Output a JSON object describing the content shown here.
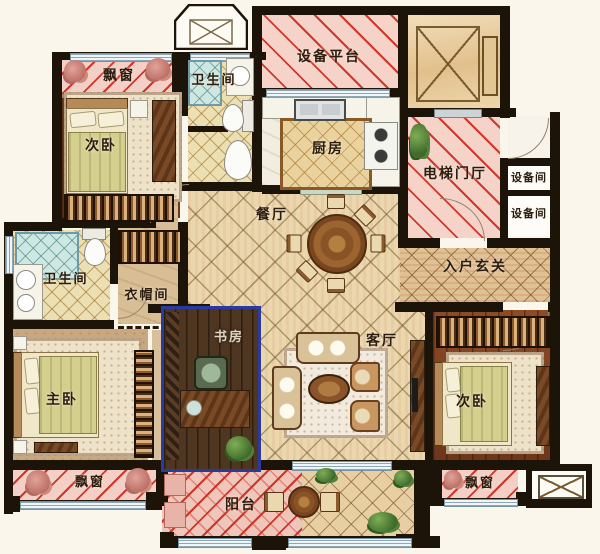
{
  "title": "三室两厅户型图 (3-bedroom apartment floor plan)",
  "labels": {
    "bay_window_top_left": "飘窗",
    "bedroom_top_left": "次卧",
    "bathroom_top": "卫生间",
    "equipment_platform": "设备平台",
    "kitchen": "厨房",
    "elevator_hall": "电梯门厅",
    "equipment_room_1": "设备间",
    "equipment_room_2": "设备间",
    "dining_room": "餐厅",
    "entrance_foyer": "入户玄关",
    "bathroom_left": "卫生间",
    "cloakroom": "衣帽间",
    "master_bedroom": "主卧",
    "study": "书房",
    "living_room": "客厅",
    "bedroom_right": "次卧",
    "bay_window_bottom_left": "飘窗",
    "balcony": "阳台",
    "bay_window_bottom_right": "飘窗"
  },
  "colors": {
    "background": "#fbf6eb",
    "wall": "#1c1309",
    "bay_hatch_fill": "#f4cfc5",
    "bay_hatch_line": "#cd372b",
    "wood_floor": "#7d431f",
    "tile_floor": "#ebd7ae",
    "study_highlight_border": "#2b3a9e",
    "shower_tile": "#cde7e2"
  }
}
